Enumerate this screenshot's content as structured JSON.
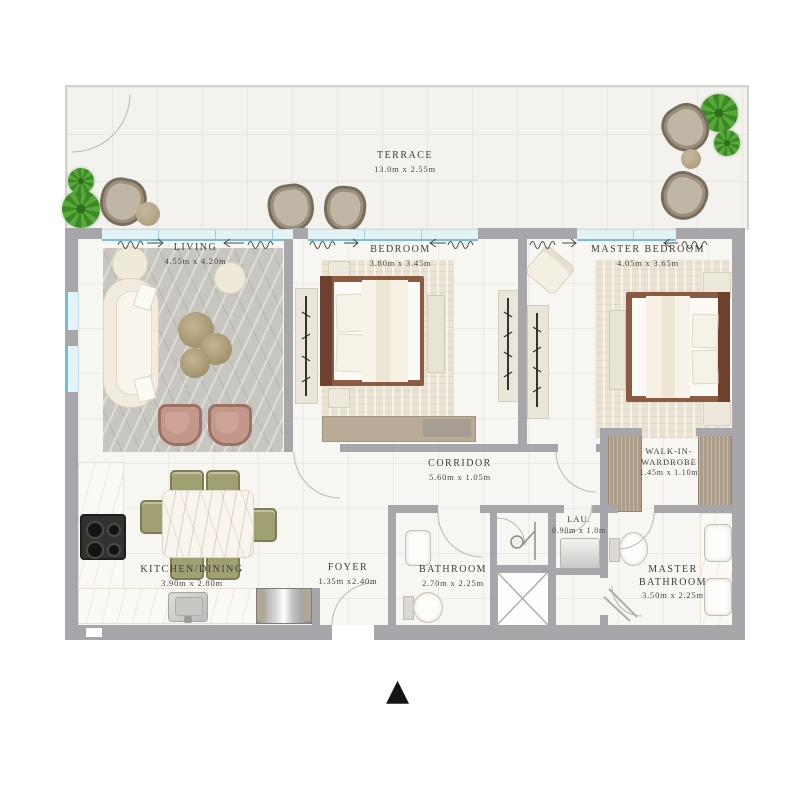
{
  "rooms": {
    "terrace": {
      "label": "TERRACE",
      "dims": "13.0m x 2.55m"
    },
    "living": {
      "label": "LIVING",
      "dims": "4.55m x 4.20m"
    },
    "bedroom": {
      "label": "BEDROOM",
      "dims": "3.80m x 3.45m"
    },
    "master_bedroom": {
      "label": "MASTER BEDROOM",
      "dims": "4.05m x 3.65m"
    },
    "corridor": {
      "label": "CORRIDOR",
      "dims": "5.60m x 1.05m"
    },
    "walk_in_wardrobe": {
      "label": "WALK-IN-WARDROBE",
      "dims": "1.45m x 1.10m"
    },
    "laundry": {
      "label": "LAU.",
      "dims": "0.90m x 1.0m"
    },
    "kitchen_dining": {
      "label": "KITCHEN/DINING",
      "dims": "3.90m x 2.80m"
    },
    "foyer": {
      "label": "FOYER",
      "dims": "1.35m x2.40m"
    },
    "bathroom": {
      "label": "BATHROOM",
      "dims": "2.70m x 2.25m"
    },
    "master_bathroom": {
      "label": "MASTER BATHROOM",
      "dims": "3.50m x 2.25m"
    }
  },
  "icons": {
    "north_arrow": "▲"
  },
  "palette": {
    "wall": "#a7a7ab",
    "floor": "#f7f6f3",
    "terrace_floor": "#f3f2ee",
    "window_glass": "#e3f2f7",
    "window_frame": "#76bed6",
    "rug_gray": "#c8c6c1",
    "rug_beige": "#eae3d4",
    "wood_bed_frame": "#8a5a42",
    "plant_green": "#3b8a25",
    "accent_armchair": "#c2978c",
    "dining_chair_olive": "#a1a072",
    "terrace_chair_tan": "#c0b6a5",
    "wardrobe_tan": "#ab9d89"
  }
}
